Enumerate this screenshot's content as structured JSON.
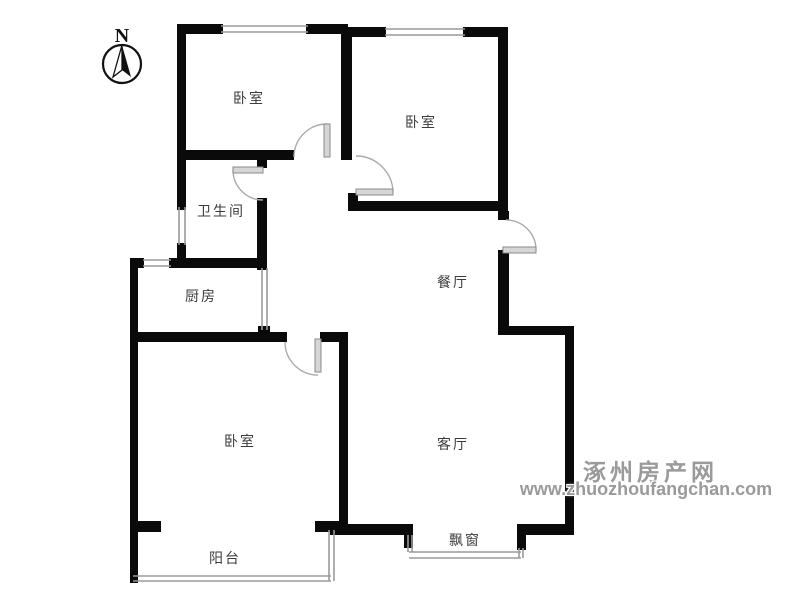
{
  "floorplan": {
    "title": "apartment-floor-plan",
    "compass": {
      "letter": "N"
    },
    "rooms": [
      {
        "id": "bedroom-top-left",
        "label": "卧室"
      },
      {
        "id": "bedroom-top-right",
        "label": "卧室"
      },
      {
        "id": "bathroom",
        "label": "卫生间"
      },
      {
        "id": "kitchen",
        "label": "厨房"
      },
      {
        "id": "dining-room",
        "label": "餐厅"
      },
      {
        "id": "bedroom-bottom-left",
        "label": "卧室"
      },
      {
        "id": "living-room",
        "label": "客厅"
      },
      {
        "id": "balcony",
        "label": "阳台"
      },
      {
        "id": "bay-window",
        "label": "飘窗"
      }
    ],
    "watermark": {
      "site_name": "涿州房产网",
      "site_url": "www.zhuozhoufangchan.com",
      "color": "#9a9a9a"
    },
    "colors": {
      "wall": "#0a0a0a",
      "window_line": "#9a9a9a",
      "door_leaf": "#d6d6d6",
      "door_arc": "#aaaaaa",
      "label_text": "#3c3c3c"
    }
  }
}
